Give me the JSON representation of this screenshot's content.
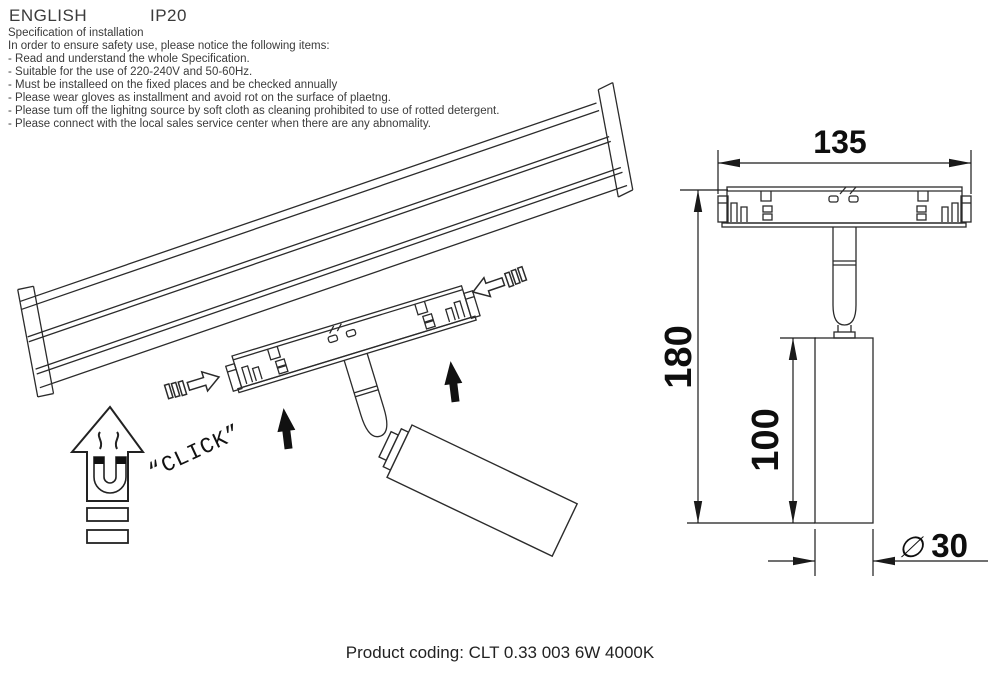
{
  "header": {
    "language": "ENGLISH",
    "ip_rating": "IP20"
  },
  "specification": {
    "title": "Specification of installation",
    "intro": "In order to ensure safety use, please notice the following items:",
    "items": [
      "- Read and understand the whole Specification.",
      "- Suitable for the use of 220-240V and 50-60Hz.",
      "- Must be installeed on the fixed places and be checked annually",
      "- Please wear gloves as installment and avoid rot on the surface of plaetng.",
      "- Please tum off the lighitng source by soft cloth as cleaning prohibited to use of rotted detergent.",
      "- Please connect with the local sales service center when there are any abnomality."
    ]
  },
  "installation_diagram": {
    "click_label": "“CLICK”",
    "icons": {
      "magnet_icon": "magnet-up-arrow-icon",
      "push_icon": "black-up-arrow-icon",
      "slide_icon": "outline-slide-arrow-icon"
    }
  },
  "dimension_diagram": {
    "width_mm": "135",
    "total_height_mm": "180",
    "body_height_mm": "100",
    "diameter_symbol": "∅",
    "diameter_mm": "30"
  },
  "footer": {
    "product_coding": "Product coding: CLT 0.33 003 6W 4000K"
  },
  "colors": {
    "line": "#2b2b2b",
    "text": "#333333",
    "dim_text": "#0e0e0e"
  }
}
